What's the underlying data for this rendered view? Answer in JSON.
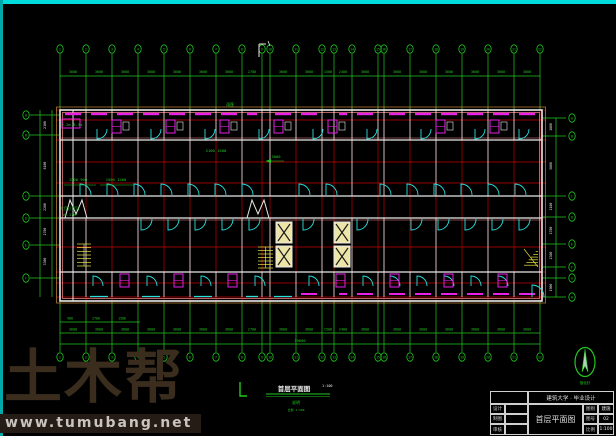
{
  "watermark": {
    "brand": "土木帮",
    "url": "www.tumubang.net"
  },
  "drawing_label": {
    "title": "首层平面图",
    "scale": "1:100",
    "note1": "说明",
    "note2": "比例 1:100"
  },
  "north_label": "指北针",
  "title_block": {
    "project": "建筑大学 · 毕业设计",
    "drawing_name": "首层平面图",
    "left_rows": [
      [
        "设计",
        ""
      ],
      [
        "制图",
        ""
      ],
      [
        "审核",
        ""
      ]
    ],
    "right_rows": [
      [
        "图别",
        "建施"
      ],
      [
        "图号",
        "02"
      ],
      [
        "比例",
        "1:100"
      ]
    ]
  },
  "colors": {
    "green": "#21c821",
    "red": "#c40000",
    "white": "#e9e9e9",
    "salmon": "#ff8c8c",
    "cyan": "#27e0e0",
    "magenta": "#e820e8",
    "yellow": "#e8e23a",
    "pale_yellow": "#ede5a8",
    "tan": "#c8883c"
  },
  "plan": {
    "axes_x": [
      60,
      86,
      112,
      138,
      164,
      190,
      216,
      242,
      262,
      270,
      296,
      322,
      334,
      352,
      378,
      384,
      410,
      436,
      462,
      488,
      514,
      540
    ],
    "axis_labels_top": [
      "1",
      "2",
      "3",
      "4",
      "5",
      "6",
      "7",
      "8",
      "9",
      "10",
      "11",
      "12",
      "13",
      "14",
      "15",
      "16",
      "17",
      "18",
      "19",
      "20",
      "21",
      "22"
    ],
    "dims_top": [
      "3600",
      "3600",
      "3600",
      "3600",
      "3600",
      "3600",
      "3600",
      "2700",
      "900",
      "3600",
      "3600",
      "1500",
      "2400",
      "3600",
      "600",
      "3600",
      "3600",
      "3600",
      "3600",
      "3600",
      "3600"
    ],
    "dims_bottom": [
      "3600",
      "3600",
      "3600",
      "3600",
      "3600",
      "3600",
      "3600",
      "2700",
      "900",
      "3600",
      "3600",
      "1500",
      "2400",
      "3600",
      "600",
      "3600",
      "3600",
      "3600",
      "3600",
      "3600",
      "3600"
    ],
    "dims_bottom_sub": [
      "900",
      "2700",
      "1500"
    ],
    "dims_total": "39600",
    "left_axes_y": [
      115,
      135,
      196,
      218,
      245,
      278
    ],
    "left_axis_labels": [
      "A",
      "B",
      "C",
      "D",
      "E",
      "F"
    ],
    "dims_left": [
      "2100",
      "6100",
      "2200",
      "2700",
      "3300"
    ],
    "right_axes_y": [
      118,
      136,
      196,
      217,
      244,
      267,
      278,
      297
    ],
    "right_axis_labels": [
      "A",
      "B",
      "C",
      "D",
      "E",
      "F",
      "G",
      "H"
    ],
    "dims_right": [
      "1800",
      "5800",
      "2100",
      "2700",
      "2300",
      "1100",
      "1900"
    ],
    "doors_top_x": [
      97,
      151,
      205,
      259,
      313,
      367,
      421,
      475,
      519
    ],
    "doors_mid_x": [
      80,
      107,
      134,
      161,
      188,
      215,
      242,
      299,
      326,
      380,
      407,
      434,
      461,
      488,
      515
    ],
    "doors_cor_x": [
      141,
      168,
      195,
      222,
      249,
      303,
      357,
      411,
      438,
      465,
      492,
      519
    ],
    "doors_bot_x": [
      93,
      147,
      201,
      255,
      309,
      363,
      390,
      417,
      444,
      471,
      498
    ],
    "fixtures_top_x": [
      112,
      166,
      220,
      274,
      328,
      436,
      490
    ],
    "fixtures_bot_x": [
      120,
      174,
      228,
      336,
      390,
      444,
      498
    ],
    "annotations": [
      {
        "t": "2.2m 3.3m",
        "x": 72,
        "y": 126
      },
      {
        "t": "1500 900",
        "x": 78,
        "y": 181
      },
      {
        "t": "1500 1200",
        "x": 116,
        "y": 181
      },
      {
        "t": "大厅(门厅)",
        "x": 70,
        "y": 210
      },
      {
        "t": "16.17m²",
        "x": 70,
        "y": 216
      },
      {
        "t": "2100 1500",
        "x": 216,
        "y": 152
      },
      {
        "t": "3000",
        "x": 276,
        "y": 158
      },
      {
        "t": "雨篷",
        "x": 230,
        "y": 106
      },
      {
        "t": "39600",
        "x": 300,
        "y": 342
      }
    ]
  }
}
